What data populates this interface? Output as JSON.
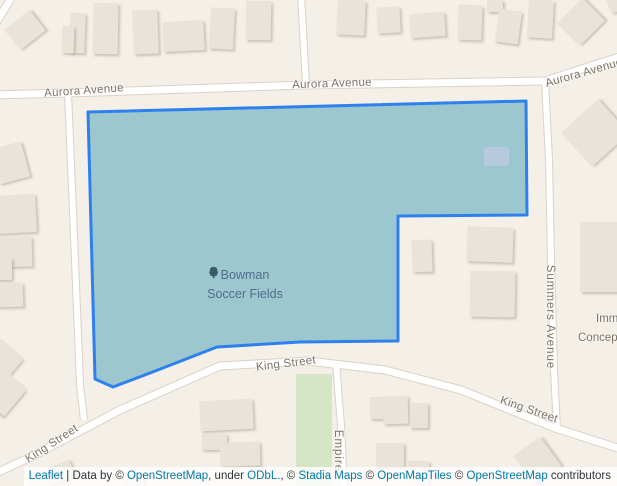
{
  "colors": {
    "land": "#f4efe7",
    "building": "#e9e4d9",
    "road": "#ffffff",
    "casing": "#d9d3c8",
    "green": "#d6e5c6",
    "polyfill": "#9cc7ce",
    "polystroke": "#2e80ed",
    "innerb": "#b7c9de",
    "streetlbl": "#7a7467",
    "poitext": "#4f6e8d",
    "poiicon": "#3a5a68",
    "attrlink": "#0078a8",
    "attrtext": "#333333"
  },
  "poi": {
    "line1": "Bowman",
    "line2": "Soccer Fields",
    "icon": "tree-icon"
  },
  "map": {
    "polygon": {
      "name": "bowman-soccer-fields",
      "points": "88,112 526,101 527,215 398,216 398,341 300,342 217,347 150,373 113,387 95,379",
      "inner_building": {
        "x": 484,
        "y": 147,
        "w": 25,
        "h": 19
      }
    },
    "green_strip": {
      "x": 296,
      "y": 374,
      "w": 36,
      "h": 112
    },
    "roads": [
      {
        "name": "aurora-avenue",
        "d": "M -8 95 L 68 93 L 305 85 L 545 81 L 622 56",
        "w": 7
      },
      {
        "name": "corner-road",
        "d": "M -6 26 L 15 -8",
        "w": 7
      },
      {
        "name": "north-road",
        "d": "M 301 -5 L 306 84",
        "w": 6
      },
      {
        "name": "west-road",
        "d": "M 68 93 L 75 260 L 80 385 L 84 420",
        "w": 6
      },
      {
        "name": "king-street",
        "d": "M -8 475 L 33 456 L 120 410 L 220 366 L 308 361 L 385 370 L 461 390 L 555 428 L 624 450",
        "w": 7
      },
      {
        "name": "summers-avenue",
        "d": "M 545 81 L 549 160 L 551 260 L 554 370 L 557 429",
        "w": 6
      },
      {
        "name": "empire-street",
        "d": "M 336 363 L 341 425 L 344 490",
        "w": 6
      }
    ],
    "buildings": [
      {
        "x": 9,
        "y": 17,
        "w": 32,
        "h": 26,
        "r": -38
      },
      {
        "x": 70,
        "y": 13,
        "w": 15,
        "h": 40,
        "r": 2
      },
      {
        "x": 62,
        "y": 26,
        "w": 12,
        "h": 27,
        "r": 2
      },
      {
        "x": 93,
        "y": 3,
        "w": 25,
        "h": 51,
        "r": 1
      },
      {
        "x": 133,
        "y": 10,
        "w": 25,
        "h": 44,
        "r": -2
      },
      {
        "x": 163,
        "y": 21,
        "w": 41,
        "h": 30,
        "r": -3
      },
      {
        "x": 210,
        "y": 8,
        "w": 24,
        "h": 41,
        "r": 3
      },
      {
        "x": 246,
        "y": 1,
        "w": 25,
        "h": 39,
        "r": 1
      },
      {
        "x": 337,
        "y": 0,
        "w": 28,
        "h": 35,
        "r": 3
      },
      {
        "x": 377,
        "y": 7,
        "w": 23,
        "h": 26,
        "r": -3
      },
      {
        "x": 410,
        "y": 13,
        "w": 35,
        "h": 24,
        "r": -4
      },
      {
        "x": 458,
        "y": 5,
        "w": 24,
        "h": 35,
        "r": 2
      },
      {
        "x": 487,
        "y": 0,
        "w": 16,
        "h": 12,
        "r": 0
      },
      {
        "x": 497,
        "y": 10,
        "w": 23,
        "h": 33,
        "r": 8
      },
      {
        "x": 528,
        "y": 0,
        "w": 25,
        "h": 38,
        "r": 3
      },
      {
        "x": 563,
        "y": 6,
        "w": 36,
        "h": 32,
        "r": -45
      },
      {
        "x": 608,
        "y": -6,
        "w": 14,
        "h": 18,
        "r": -20
      },
      {
        "x": -6,
        "y": 145,
        "w": 32,
        "h": 36,
        "r": -15
      },
      {
        "x": -4,
        "y": 195,
        "w": 40,
        "h": 38,
        "r": -3
      },
      {
        "x": -4,
        "y": 237,
        "w": 36,
        "h": 30,
        "r": -2
      },
      {
        "x": -8,
        "y": 258,
        "w": 20,
        "h": 22,
        "r": 0
      },
      {
        "x": -4,
        "y": 283,
        "w": 27,
        "h": 24,
        "r": -2
      },
      {
        "x": -12,
        "y": 345,
        "w": 30,
        "h": 30,
        "r": 40
      },
      {
        "x": -16,
        "y": 373,
        "w": 36,
        "h": 36,
        "r": 40
      },
      {
        "x": 28,
        "y": 468,
        "w": 46,
        "h": 17,
        "r": -23
      },
      {
        "x": 200,
        "y": 400,
        "w": 53,
        "h": 30,
        "r": -3
      },
      {
        "x": 202,
        "y": 434,
        "w": 25,
        "h": 16,
        "r": 0
      },
      {
        "x": 220,
        "y": 442,
        "w": 40,
        "h": 24,
        "r": -2
      },
      {
        "x": 122,
        "y": 479,
        "w": 22,
        "h": 7,
        "r": 0
      },
      {
        "x": 370,
        "y": 397,
        "w": 13,
        "h": 22,
        "r": 0
      },
      {
        "x": 383,
        "y": 396,
        "w": 25,
        "h": 28,
        "r": -2
      },
      {
        "x": 410,
        "y": 403,
        "w": 18,
        "h": 25,
        "r": 0
      },
      {
        "x": 376,
        "y": 443,
        "w": 28,
        "h": 24,
        "r": 0
      },
      {
        "x": 408,
        "y": 461,
        "w": 21,
        "h": 25,
        "r": 0
      },
      {
        "x": 521,
        "y": 443,
        "w": 33,
        "h": 36,
        "r": -36
      },
      {
        "x": 412,
        "y": 240,
        "w": 20,
        "h": 32,
        "r": -2
      },
      {
        "x": 467,
        "y": 227,
        "w": 46,
        "h": 35,
        "r": 2
      },
      {
        "x": 470,
        "y": 271,
        "w": 45,
        "h": 46,
        "r": 1
      },
      {
        "x": 570,
        "y": 110,
        "w": 50,
        "h": 46,
        "r": -42
      },
      {
        "x": 580,
        "y": 222,
        "w": 38,
        "h": 70,
        "r": 0
      }
    ],
    "street_labels": [
      {
        "text": "Aurora Avenue",
        "x": 84,
        "y": 91,
        "rot": -4,
        "vertical": false
      },
      {
        "text": "Aurora Avenue",
        "x": 332,
        "y": 84,
        "rot": -2,
        "vertical": false
      },
      {
        "text": "Aurora Avenue",
        "x": 584,
        "y": 73,
        "rot": -16,
        "vertical": false
      },
      {
        "text": "King Street",
        "x": 52,
        "y": 444,
        "rot": -33,
        "vertical": false
      },
      {
        "text": "King Street",
        "x": 286,
        "y": 364,
        "rot": -7,
        "vertical": false
      },
      {
        "text": "King Street",
        "x": 529,
        "y": 410,
        "rot": 19,
        "vertical": false
      },
      {
        "text": "Summers Avenue",
        "x": 550,
        "y": 317,
        "rot": 0,
        "vertical": true
      },
      {
        "text": "Empire",
        "x": 338,
        "y": 451,
        "rot": 0,
        "vertical": true
      }
    ],
    "place_labels": [
      {
        "text": "Imm",
        "x": 596,
        "y": 313
      },
      {
        "text": "Concept",
        "x": 578,
        "y": 332
      }
    ]
  },
  "attribution": {
    "parts": [
      {
        "text": "Leaflet",
        "link": true
      },
      {
        "text": " | Data by © ",
        "link": false
      },
      {
        "text": "OpenStreetMap",
        "link": true
      },
      {
        "text": ", under ",
        "link": false
      },
      {
        "text": "ODbL.",
        "link": true
      },
      {
        "text": ", © ",
        "link": false
      },
      {
        "text": "Stadia Maps",
        "link": true
      },
      {
        "text": " © ",
        "link": false
      },
      {
        "text": "OpenMapTiles",
        "link": true
      },
      {
        "text": " © ",
        "link": false
      },
      {
        "text": "OpenStreetMap",
        "link": true
      },
      {
        "text": " contributors",
        "link": false
      }
    ]
  }
}
